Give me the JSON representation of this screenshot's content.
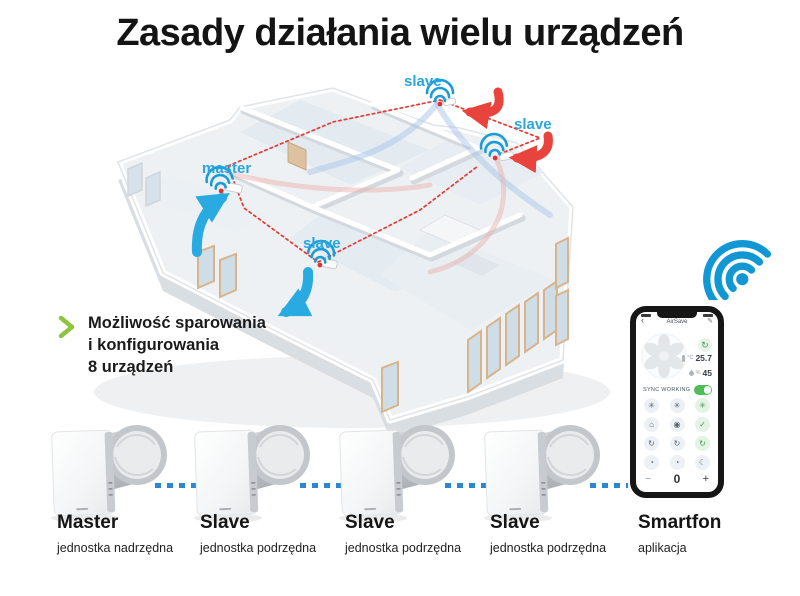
{
  "title": "Zasady działania wielu urządzeń",
  "feature": {
    "line1": "Możliwość sparowania",
    "line2": "i konfigurowania",
    "line3": "8 urządzeń"
  },
  "house_units": [
    {
      "label": "master"
    },
    {
      "label": "slave"
    },
    {
      "label": "slave"
    },
    {
      "label": "slave"
    }
  ],
  "devices": [
    {
      "name": "Master",
      "subtitle": "jednostka nadrzędna"
    },
    {
      "name": "Slave",
      "subtitle": "jednostka podrzędna"
    },
    {
      "name": "Slave",
      "subtitle": "jednostka podrzędna"
    },
    {
      "name": "Slave",
      "subtitle": "jednostka podrzędna"
    }
  ],
  "smartphone_label": {
    "name": "Smartfon",
    "subtitle": "aplikacja"
  },
  "app": {
    "title": "AirSave",
    "back_glyph": "‹",
    "edit_glyph": "✎",
    "refresh_glyph": "↻",
    "temp_unit": "°C",
    "temp_value": "25.7",
    "hum_unit": "%",
    "hum_value": "45",
    "sync_label": "SYNC WORKING",
    "modes": [
      {
        "name": "fan-speed-1-icon",
        "glyph": "✳"
      },
      {
        "name": "fan-speed-2-icon",
        "glyph": "✳"
      },
      {
        "name": "fan-auto-icon",
        "glyph": "✳"
      },
      {
        "name": "home-mode-icon",
        "glyph": "⌂"
      },
      {
        "name": "humidity-mode-icon",
        "glyph": "◉"
      },
      {
        "name": "eco-mode-icon",
        "glyph": "✓"
      },
      {
        "name": "auto-cycle-1-icon",
        "glyph": "↻"
      },
      {
        "name": "auto-cycle-2-icon",
        "glyph": "↻"
      },
      {
        "name": "auto-cycle-3-icon",
        "glyph": "↻"
      },
      {
        "name": "timer-1-icon",
        "glyph": "◔"
      },
      {
        "name": "timer-2-icon",
        "glyph": "◔"
      },
      {
        "name": "night-mode-icon",
        "glyph": "☾"
      }
    ],
    "stepper": {
      "minus": "−",
      "value": "0",
      "plus": "+"
    }
  },
  "colors": {
    "label_blue": "#2aa6df",
    "arrow_blue": "#29abe2",
    "arrow_red": "#e8433c",
    "dotted_red": "#e53935",
    "connector_blue": "#2b87d1",
    "wifi_blue": "#1198d4",
    "chevron_green": "#8fc53e"
  }
}
